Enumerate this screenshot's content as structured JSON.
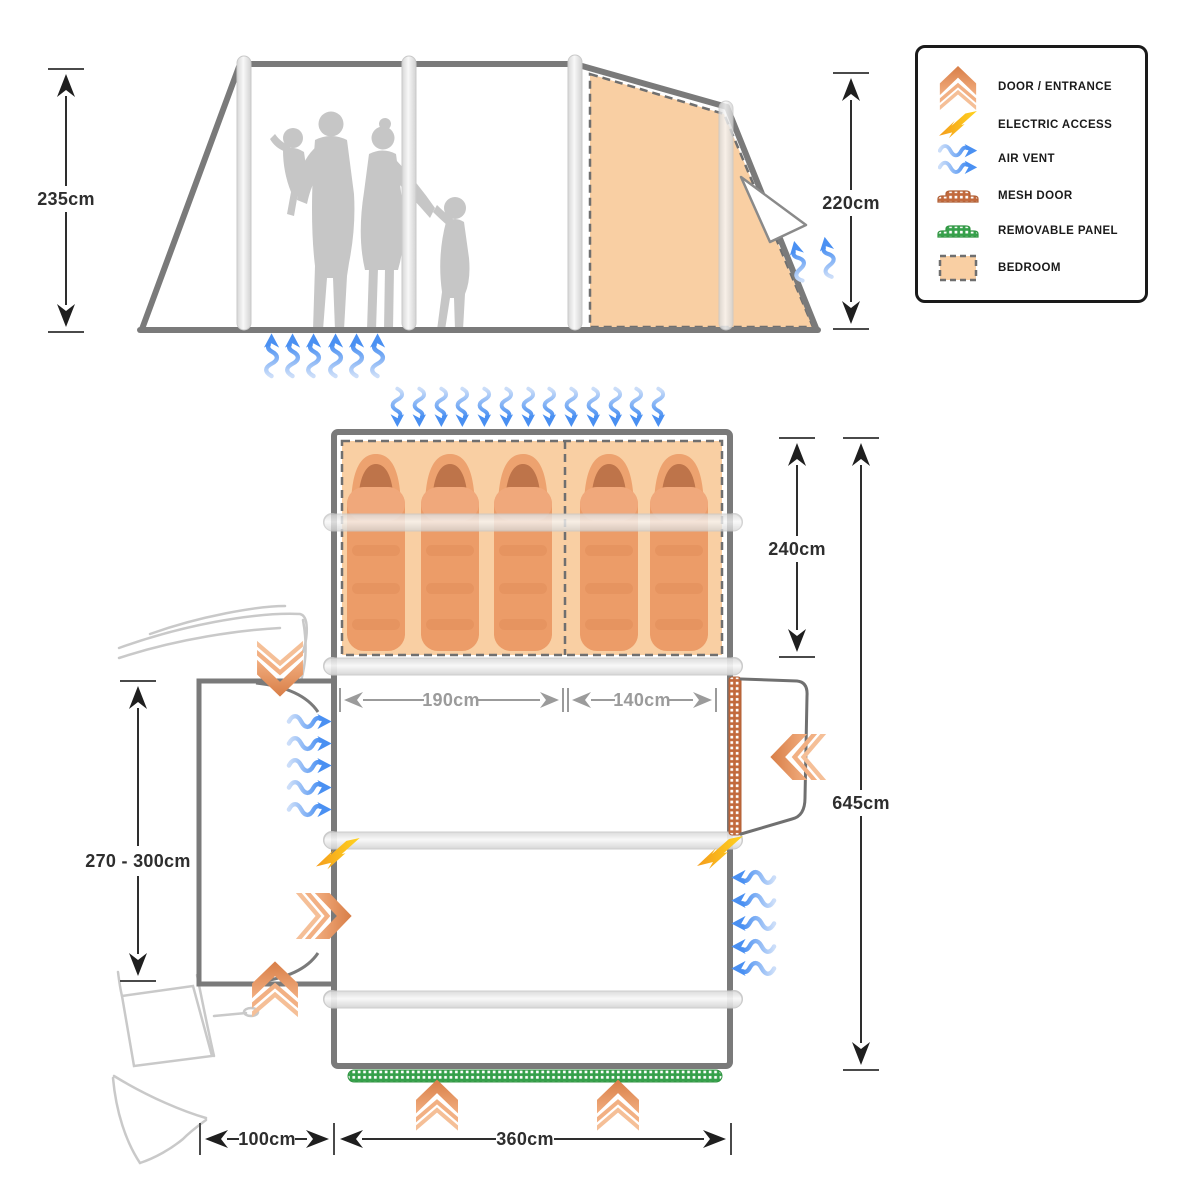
{
  "title": "Tent / drive-away awning dimensions diagram",
  "legend": {
    "items": [
      {
        "icon": "door-entrance-icon",
        "label": "DOOR / ENTRANCE"
      },
      {
        "icon": "electric-access-icon",
        "label": "ELECTRIC ACCESS"
      },
      {
        "icon": "air-vent-icon",
        "label": "AIR VENT"
      },
      {
        "icon": "mesh-door-icon",
        "label": "MESH DOOR"
      },
      {
        "icon": "removable-panel-icon",
        "label": "REMOVABLE PANEL"
      },
      {
        "icon": "bedroom-icon",
        "label": "BEDROOM"
      }
    ]
  },
  "dimensions": {
    "side_height": "235cm",
    "rear_height": "220cm",
    "bedroom_depth": "240cm",
    "total_length": "645cm",
    "bedroom_left_width": "190cm",
    "bedroom_right_width": "140cm",
    "tunnel_length_range": "270 - 300cm",
    "tunnel_width": "100cm",
    "main_width": "360cm"
  },
  "features": {
    "sleeping_bag_count": 5,
    "bedroom_sections": 2
  },
  "colors": {
    "outline_gray": "#7a7a7a",
    "bedroom_fill": "#f9cfa3",
    "accent_orange": "#e08850",
    "accent_blue": "#4a90f2",
    "accent_yellow": "#ffd21e",
    "accent_green": "#35a04a",
    "silhouette_gray": "#c6c6c6",
    "dim_text": "#2e2e2e",
    "dim_text_gray": "#9b9b9b"
  }
}
